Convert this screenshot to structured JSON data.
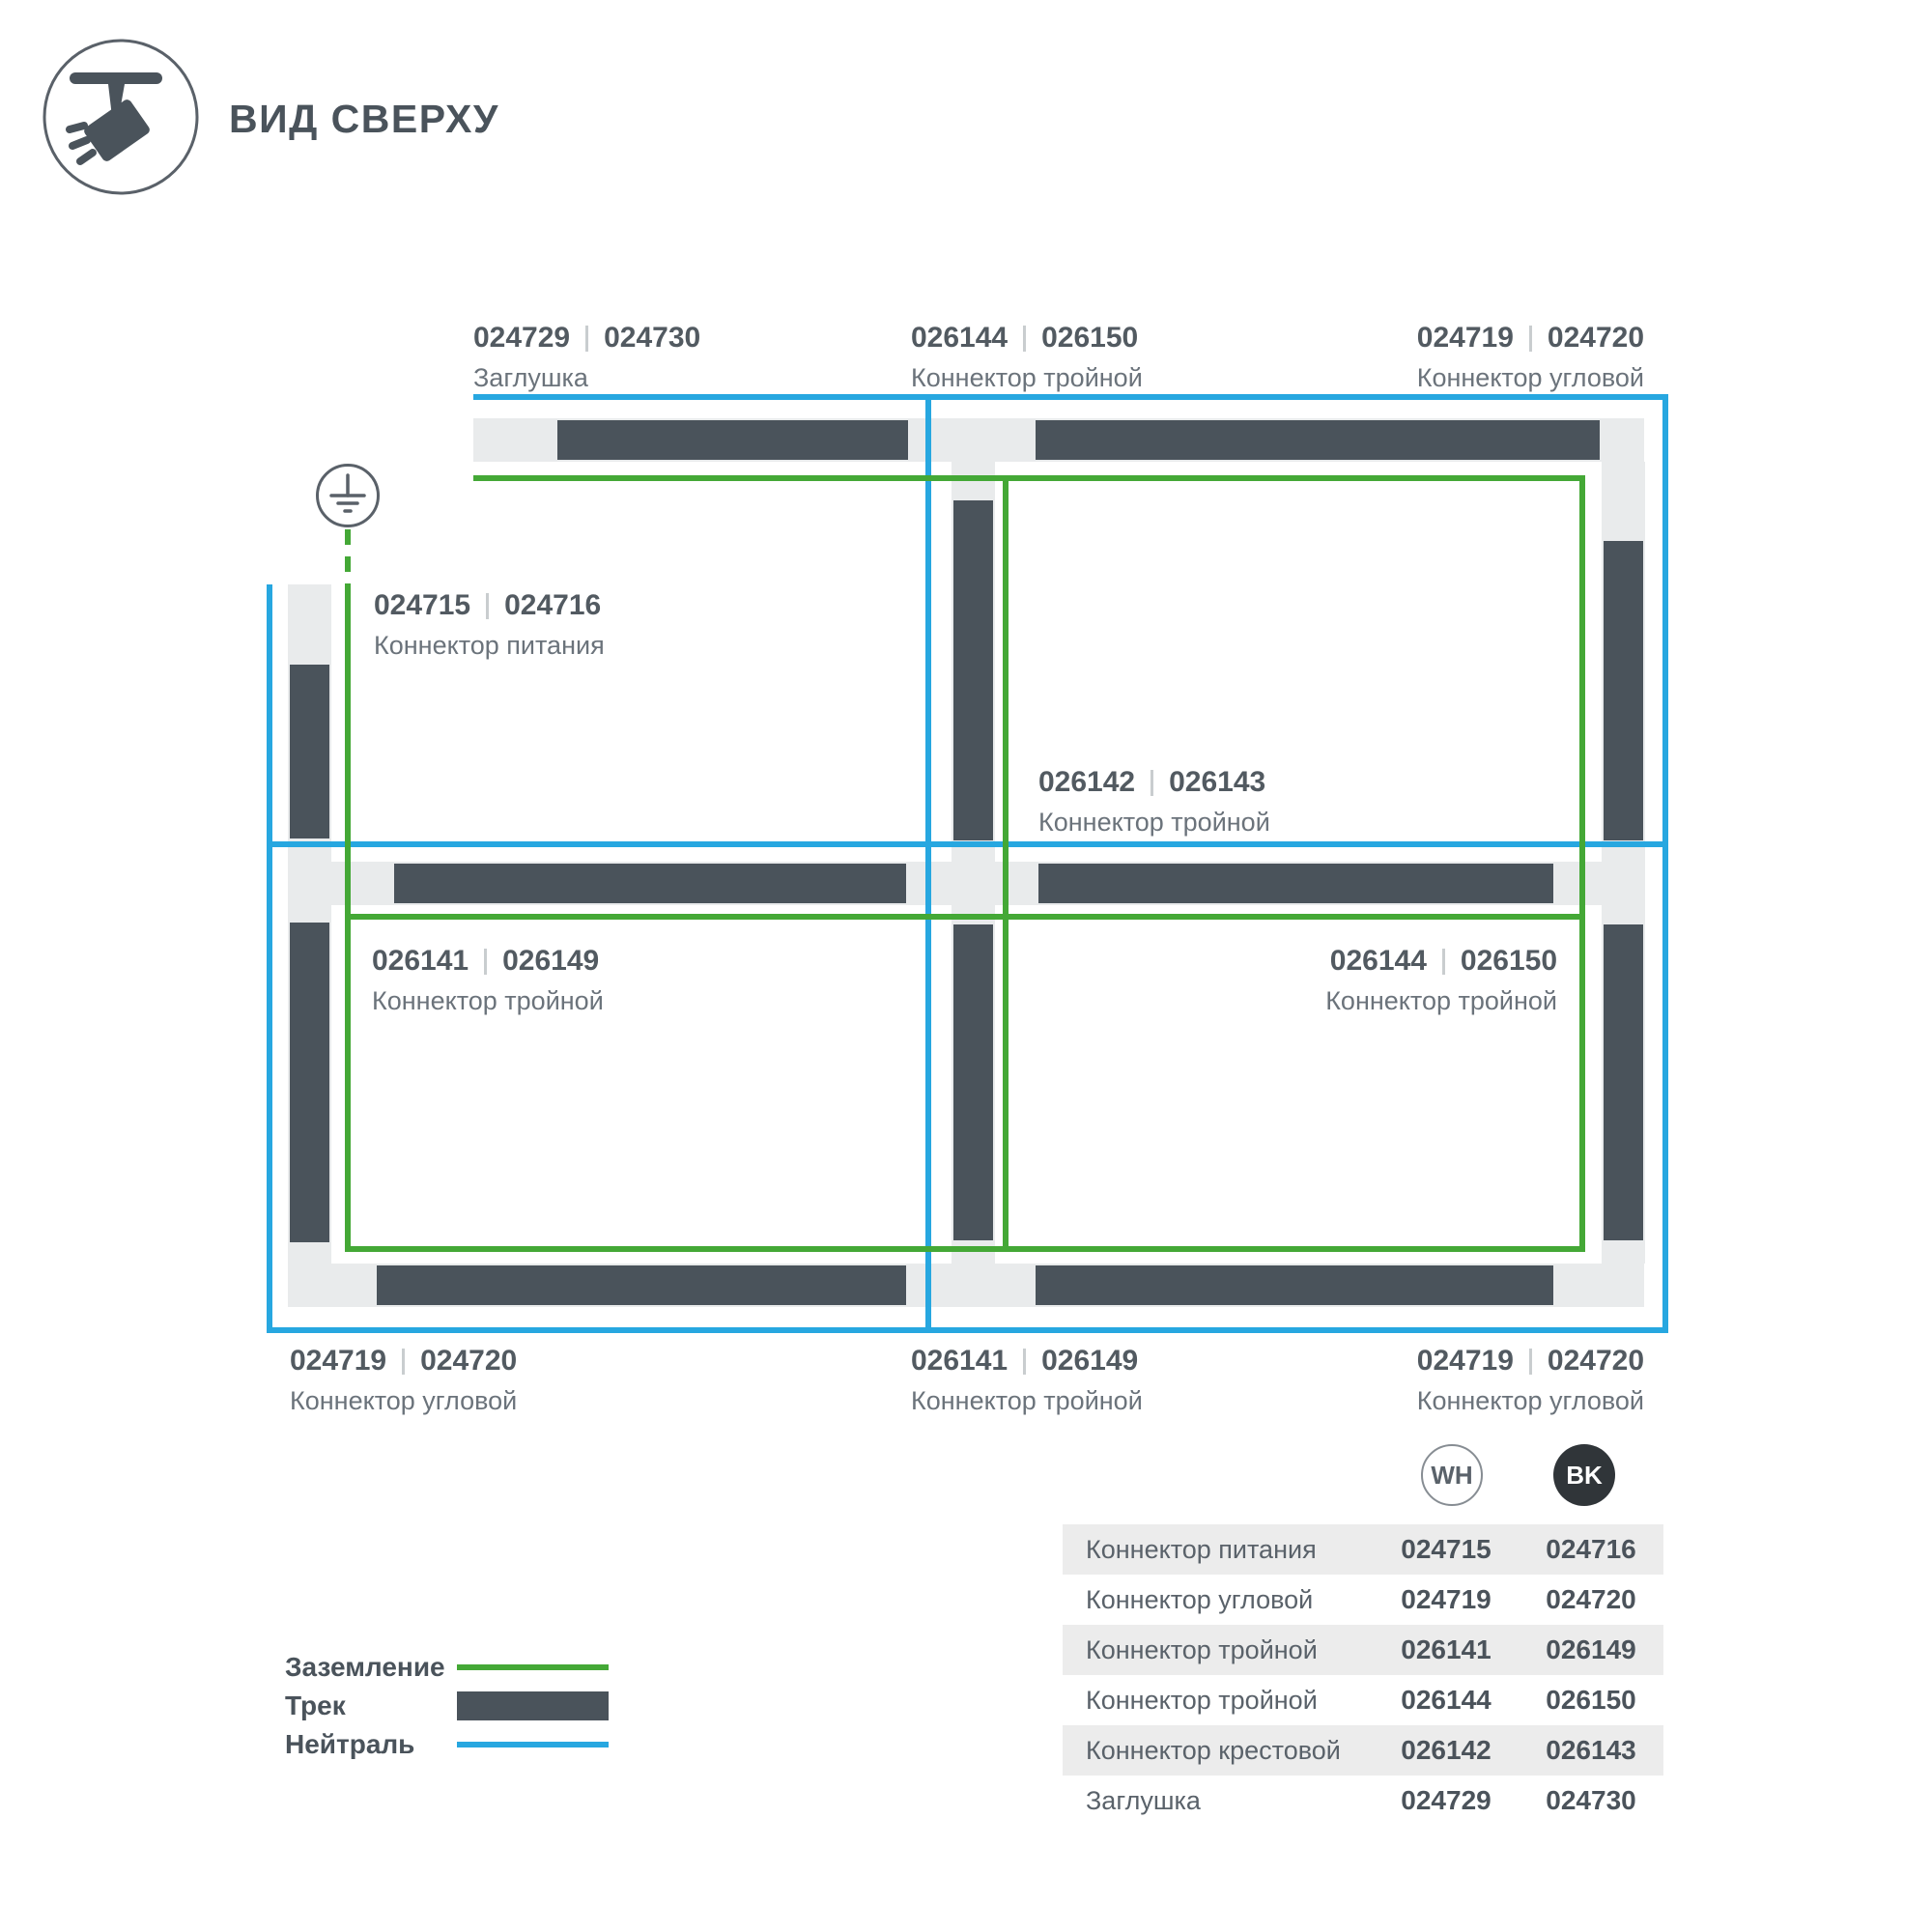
{
  "header": {
    "title": "ВИД СВЕРХУ",
    "icon": "track-spotlight-icon"
  },
  "diagram": {
    "labels": [
      {
        "codes": [
          "024729",
          "024730"
        ],
        "name": "Заглушка"
      },
      {
        "codes": [
          "026144",
          "026150"
        ],
        "name": "Коннектор тройной"
      },
      {
        "codes": [
          "024719",
          "024720"
        ],
        "name": "Коннектор угловой"
      },
      {
        "codes": [
          "024715",
          "024716"
        ],
        "name": "Коннектор питания"
      },
      {
        "codes": [
          "026142",
          "026143"
        ],
        "name": "Коннектор тройной"
      },
      {
        "codes": [
          "026141",
          "026149"
        ],
        "name": "Коннектор тройной"
      },
      {
        "codes": [
          "026144",
          "026150"
        ],
        "name": "Коннектор тройной"
      },
      {
        "codes": [
          "024719",
          "024720"
        ],
        "name": "Коннектор угловой"
      },
      {
        "codes": [
          "026141",
          "026149"
        ],
        "name": "Коннектор тройной"
      },
      {
        "codes": [
          "024719",
          "024720"
        ],
        "name": "Коннектор угловой"
      }
    ]
  },
  "legend": {
    "items": [
      {
        "label": "Заземление",
        "swatch": "line",
        "color": "#44a836"
      },
      {
        "label": "Трек",
        "swatch": "bar",
        "color": "#4a535b"
      },
      {
        "label": "Нейтраль",
        "swatch": "line",
        "color": "#27a7e0"
      }
    ]
  },
  "table": {
    "badges": [
      "WH",
      "BK"
    ],
    "rows": [
      {
        "name": "Коннектор питания",
        "wh": "024715",
        "bk": "024716"
      },
      {
        "name": "Коннектор угловой",
        "wh": "024719",
        "bk": "024720"
      },
      {
        "name": "Коннектор тройной",
        "wh": "026141",
        "bk": "026149"
      },
      {
        "name": "Коннектор тройной",
        "wh": "026144",
        "bk": "026150"
      },
      {
        "name": "Коннектор крестовой",
        "wh": "026142",
        "bk": "026143"
      },
      {
        "name": "Заглушка",
        "wh": "024729",
        "bk": "024730"
      }
    ]
  },
  "colors": {
    "track": "#4a535b",
    "connector": "#e9ebec",
    "neutral": "#27a7e0",
    "ground": "#44a836",
    "text_dark": "#525a61",
    "text_gray": "#6b737b"
  }
}
